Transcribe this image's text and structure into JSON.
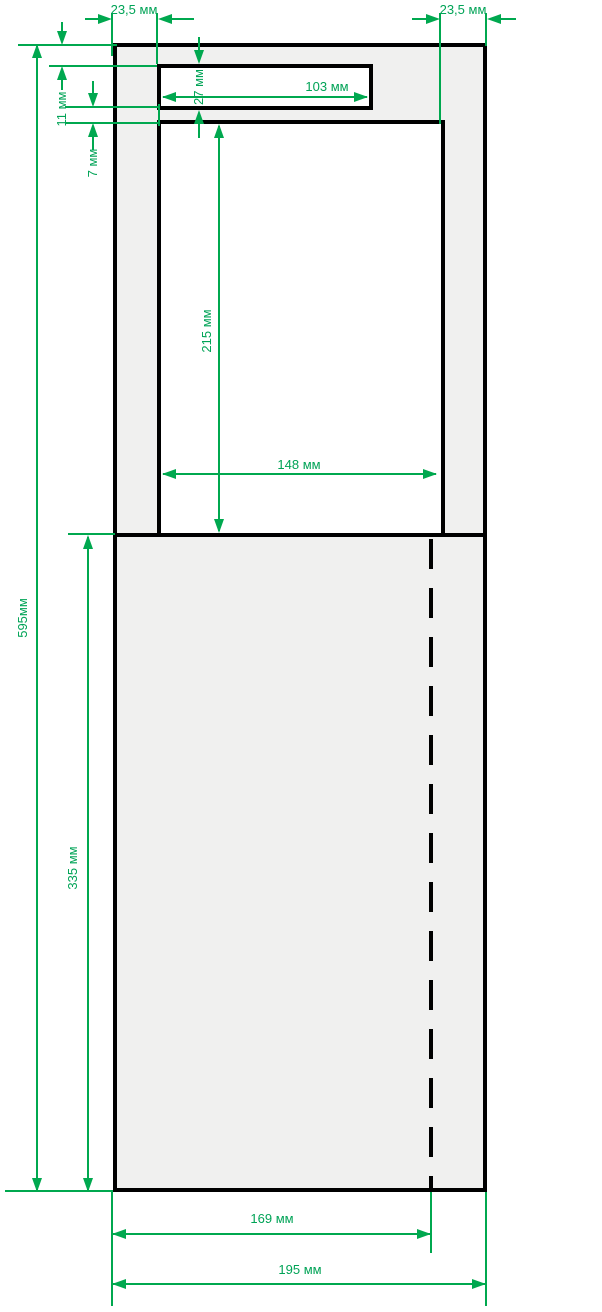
{
  "drawing": {
    "title": "panel-cutout-dimension-drawing",
    "units": "мм",
    "colors": {
      "dimension_green": "#00A84F",
      "outline_black": "#000000",
      "panel_fill_gray": "#F0F0EF",
      "cutout_white": "#FFFFFF"
    },
    "dimensions": {
      "top_left_margin": {
        "label": "23,5 мм",
        "value": 23.5
      },
      "top_right_margin": {
        "label": "23,5 мм",
        "value": 23.5
      },
      "slot_width": {
        "label": "103 мм",
        "value": 103
      },
      "slot_height": {
        "label": "27 мм",
        "value": 27
      },
      "top_to_slot": {
        "label": "11 мм",
        "value": 11
      },
      "slot_to_window": {
        "label": "7 мм",
        "value": 7
      },
      "window_height": {
        "label": "215 мм",
        "value": 215
      },
      "window_width": {
        "label": "148 мм",
        "value": 148
      },
      "total_height": {
        "label": "595мм",
        "value": 595
      },
      "lower_height": {
        "label": "335 мм",
        "value": 335
      },
      "fold_offset": {
        "label": "169 мм",
        "value": 169
      },
      "total_width": {
        "label": "195 мм",
        "value": 195
      }
    }
  }
}
